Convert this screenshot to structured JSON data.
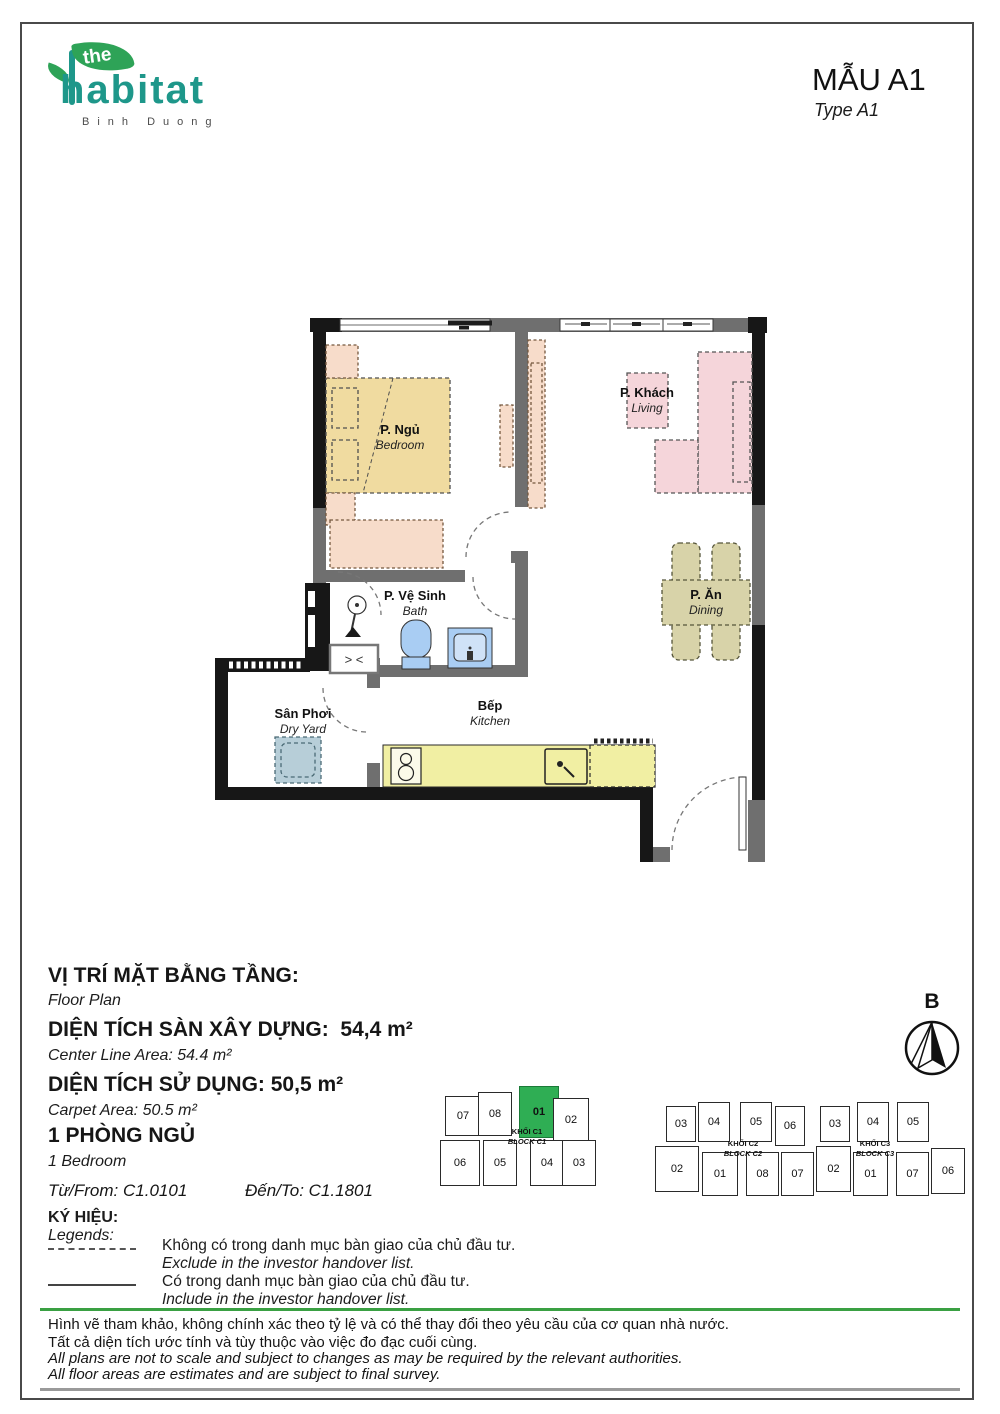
{
  "header": {
    "logo": {
      "the": "the",
      "name": "habitat",
      "subtitle": "Binh Duong"
    },
    "title_vi": "MẪU A1",
    "title_en": "Type A1"
  },
  "plan": {
    "ac_symbol": "> <",
    "rooms": [
      {
        "vi": "P. Ngủ",
        "en": "Bedroom"
      },
      {
        "vi": "P. Khách",
        "en": "Living"
      },
      {
        "vi": "P. Ăn",
        "en": "Dining"
      },
      {
        "vi": "P. Vệ Sinh",
        "en": "Bath"
      },
      {
        "vi": "Bếp",
        "en": "Kitchen"
      },
      {
        "vi": "Sân Phơi",
        "en": "Dry Yard"
      }
    ]
  },
  "info": {
    "floor_plan_vi": "VỊ TRÍ MẶT BẰNG TẦNG:",
    "floor_plan_en": "Floor Plan",
    "center_line_vi": "DIỆN TÍCH SÀN XÂY DỰNG:  54,4 m²",
    "center_line_en": "Center Line Area: 54.4 m²",
    "carpet_vi": "DIỆN TÍCH SỬ DỤNG: 50,5 m²",
    "carpet_en": "Carpet Area: 50.5 m²",
    "bedroom_vi": "1 PHÒNG NGỦ",
    "bedroom_en": "1 Bedroom",
    "from_label": "Từ/From:",
    "from_value": "C1.0101",
    "to_label": "Đến/To:",
    "to_value": "C1.1801"
  },
  "legend": {
    "title_vi": "KÝ HIỆU:",
    "title_en": "Legends:",
    "items": [
      {
        "vi": "Không có trong danh mục bàn giao của chủ đầu tư.",
        "en": "Exclude in the investor handover list."
      },
      {
        "vi": "Có trong danh mục bàn giao của chủ đầu tư.",
        "en": "Include in the investor handover list."
      }
    ]
  },
  "blocks": {
    "c1": {
      "label_vi": "KHỐI C1",
      "label_en": "BLOCK C1",
      "highlight": "01",
      "top": [
        "07",
        "08",
        "01",
        "02"
      ],
      "bottom": [
        "06",
        "05",
        "04",
        "03"
      ]
    },
    "c2": {
      "label_vi": "KHỐI C2",
      "label_en": "BLOCK C2",
      "top": [
        "03",
        "04",
        "05",
        "06"
      ],
      "bottom": [
        "02",
        "01",
        "08",
        "07"
      ]
    },
    "c3": {
      "label_vi": "KHỐI C3",
      "label_en": "BLOCK C3",
      "top": [
        "03",
        "04",
        "05"
      ],
      "bottom": [
        "02",
        "01",
        "07",
        "06"
      ]
    }
  },
  "compass": {
    "label": "B"
  },
  "footer": {
    "line1_vi": "Hình vẽ tham khảo, không chính xác theo tỷ lệ và có thể thay đổi theo yêu cầu của cơ quan nhà nước.",
    "line2_vi": "Tất cả diện tích ước tính và tùy thuộc vào việc đo đạc cuối cùng.",
    "line1_en": "All plans are not to scale and subject to changes as may be required by the relevant authorities.",
    "line2_en": "All floor areas are estimates and are subject to final survey."
  },
  "colors": {
    "accent_green": "#2fae54",
    "brand_teal": "#1e978a",
    "rule_green": "#3aa043"
  }
}
